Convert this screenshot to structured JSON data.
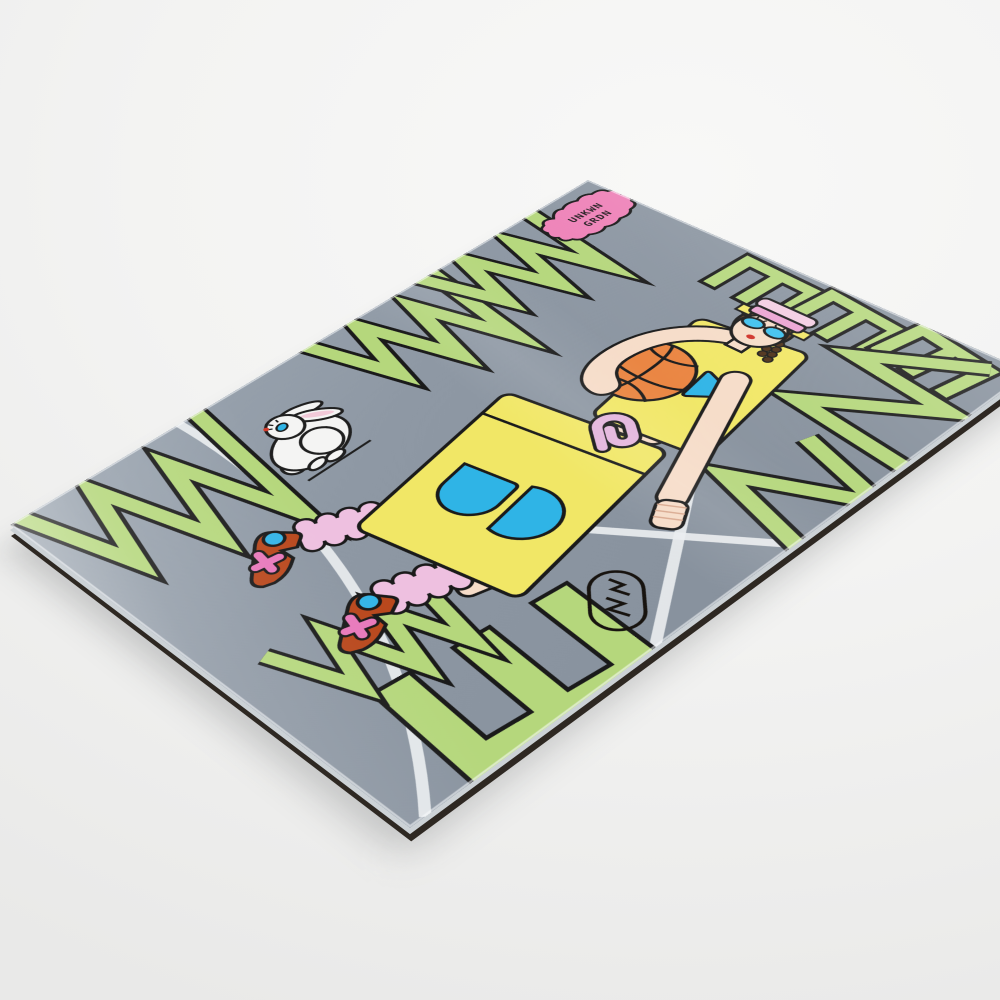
{
  "badge": {
    "line1": "UNKWN",
    "line2": "GRDN"
  },
  "colors": {
    "photo_background": "#f3f3f2",
    "panel_gray": "#8e98a4",
    "letterform_green": "#b5d77c",
    "outline_black": "#1a1a1a",
    "kit_yellow": "#f1e766",
    "accent_cyan": "#2fb4e6",
    "badge_pink": "#ee82b8",
    "squiggle_pink": "#e3b4dc",
    "sock_pink": "#eec0e0",
    "shoe_rust": "#b9481d",
    "basketball_orange": "#ea8440",
    "skin": "#f6dcc8",
    "hair_brown": "#5a3b24",
    "court_line_white": "#e9edef",
    "panel_edge_dark": "#2e2822"
  }
}
